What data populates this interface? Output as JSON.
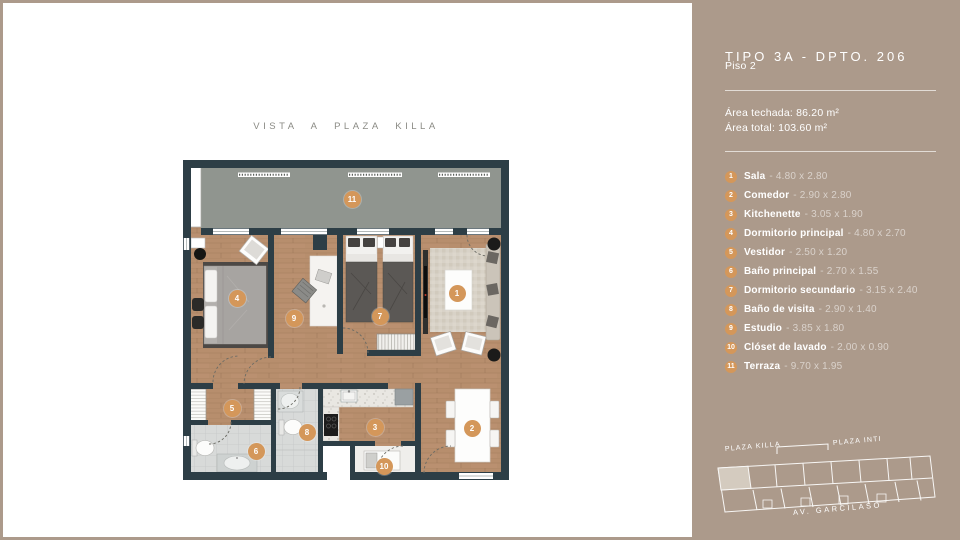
{
  "page": {
    "vista_label": "VISTA A PLAZA KILLA"
  },
  "sidebar": {
    "title": "TIPO 3A - DPTO. 206",
    "floor": "Piso 2",
    "area_techada": "Área techada: 86.20 m²",
    "area_total": "Área total: 103.60 m²",
    "rooms": [
      {
        "num": "1",
        "name": "Sala",
        "dims": "- 4.80 x 2.80"
      },
      {
        "num": "2",
        "name": "Comedor",
        "dims": "- 2.90 x 2.80"
      },
      {
        "num": "3",
        "name": "Kitchenette",
        "dims": "- 3.05 x 1.90"
      },
      {
        "num": "4",
        "name": "Dormitorio principal",
        "dims": "- 4.80 x 2.70"
      },
      {
        "num": "5",
        "name": "Vestidor",
        "dims": "- 2.50 x 1.20"
      },
      {
        "num": "6",
        "name": "Baño principal",
        "dims": "- 2.70 x 1.55"
      },
      {
        "num": "7",
        "name": "Dormitorio secundario",
        "dims": "- 3.15 x 2.40"
      },
      {
        "num": "8",
        "name": "Baño de visita",
        "dims": "- 2.90 x 1.40"
      },
      {
        "num": "9",
        "name": "Estudio",
        "dims": "- 3.85 x 1.80"
      },
      {
        "num": "10",
        "name": "Clóset de lavado",
        "dims": "- 2.00 x 0.90"
      },
      {
        "num": "11",
        "name": "Terraza",
        "dims": "- 9.70 x 1.95"
      }
    ],
    "map": {
      "label_left": "PLAZA KILLA",
      "label_right": "PLAZA INTI",
      "label_bottom": "AV. GARCILASO"
    }
  },
  "colors": {
    "accent": "#d4975a",
    "sidebar_bg": "#ac9a8b",
    "wall": "#2d3e46",
    "wood": "#b78e6d",
    "terrace": "#90958f"
  }
}
